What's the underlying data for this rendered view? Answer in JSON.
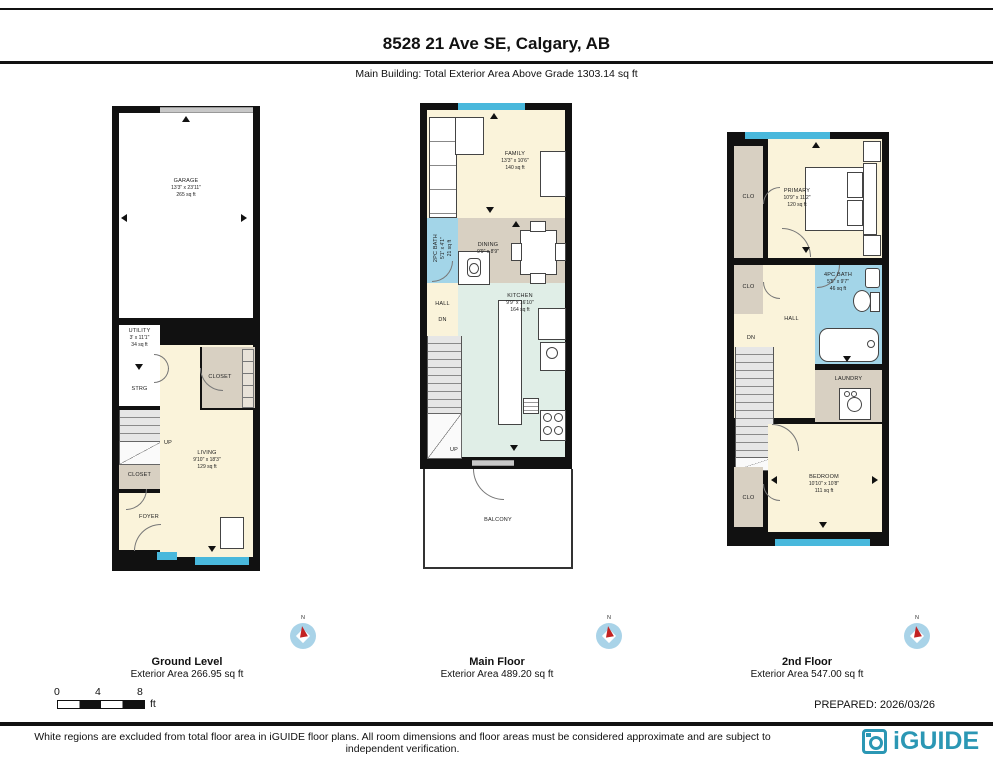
{
  "header": {
    "title": "8528 21 Ave SE, Calgary, AB",
    "subtitle": "Main Building: Total Exterior Area Above Grade 1303.14 sq ft"
  },
  "ground": {
    "caption": "Ground Level",
    "area_label": "Exterior Area 266.95 sq ft",
    "rooms": {
      "garage": {
        "name": "GARAGE",
        "dims": "13'3\" x 23'11\"",
        "area": "265 sq ft"
      },
      "utility": {
        "name": "UTILITY",
        "dims": "3' x 11'1\"",
        "area": "34 sq ft"
      },
      "strg": {
        "name": "STRG"
      },
      "closet_upper": {
        "name": "CLOSET"
      },
      "up": {
        "name": "UP"
      },
      "living": {
        "name": "LIVING",
        "dims": "9'10\" x 18'3\"",
        "area": "129 sq ft"
      },
      "closet_lower": {
        "name": "CLOSET"
      },
      "foyer": {
        "name": "FOYER"
      }
    }
  },
  "main": {
    "caption": "Main Floor",
    "area_label": "Exterior Area 489.20 sq ft",
    "rooms": {
      "family": {
        "name": "FAMILY",
        "dims": "13'3\" x 10'6\"",
        "area": "140 sq ft"
      },
      "bath": {
        "name": "2PC BATH",
        "dims": "5'1\" x 4'1\"",
        "area": "21 sq ft"
      },
      "dining": {
        "name": "DINING",
        "dims": "9'9\" x 8'9\""
      },
      "kitchen": {
        "name": "KITCHEN",
        "dims": "9'9\" x 16'10\"",
        "area": "164 sq ft"
      },
      "hall": {
        "name": "HALL"
      },
      "dn": {
        "name": "DN"
      },
      "up": {
        "name": "UP"
      },
      "balcony": {
        "name": "BALCONY"
      }
    }
  },
  "second": {
    "caption": "2nd Floor",
    "area_label": "Exterior Area 547.00 sq ft",
    "rooms": {
      "clo_top": {
        "name": "CLO"
      },
      "primary": {
        "name": "PRIMARY",
        "dims": "10'9\" x 11'2\"",
        "area": "120 sq ft"
      },
      "clo_mid": {
        "name": "CLO"
      },
      "bath": {
        "name": "4PC BATH",
        "dims": "5'5\" x 9'7\"",
        "area": "46 sq ft"
      },
      "hall": {
        "name": "HALL"
      },
      "dn": {
        "name": "DN"
      },
      "laundry": {
        "name": "LAUNDRY"
      },
      "bedroom": {
        "name": "BEDROOM",
        "dims": "10'10\" x 10'8\"",
        "area": "111 sq ft"
      },
      "clo_bottom": {
        "name": "CLO"
      }
    }
  },
  "compass": {
    "n": "N"
  },
  "scale": {
    "t0": "0",
    "t4": "4",
    "t8": "8",
    "unit": "ft"
  },
  "prepared": "PREPARED: 2026/03/26",
  "footer_note": "White regions are excluded from total floor area in iGUIDE floor plans. All room dimensions and floor areas must be considered approximate and are subject to independent verification.",
  "logo_text": "iGUIDE",
  "colors": {
    "wall": "#111111",
    "cream": "#faf3da",
    "tan": "#d8d0c2",
    "bath_blue": "#a3d5e8",
    "kitchen_mint": "#e0eee7",
    "window_blue": "#49b8dc",
    "logo_teal": "#2b97b4"
  }
}
